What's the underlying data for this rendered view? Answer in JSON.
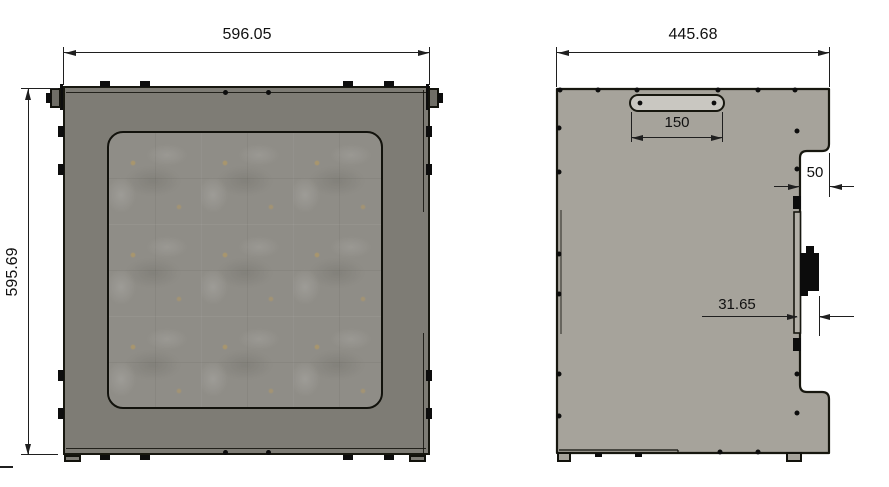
{
  "views": {
    "front": {
      "width_dim": "596.05",
      "height_dim": "595.69"
    },
    "side": {
      "width_dim": "445.68",
      "handle_width_dim": "150",
      "notch_depth_dim": "50",
      "connector_offset_dim": "31.65"
    }
  },
  "colors": {
    "front_panel": "#7e7c75",
    "side_panel": "#a6a39b",
    "window_texture": "#8f8d87",
    "handle_plate": "#c9c7c1",
    "connector": "#0c0c0c",
    "outline": "#17170f",
    "dimension_lines": "#1f1f1f",
    "background": "#ffffff"
  }
}
